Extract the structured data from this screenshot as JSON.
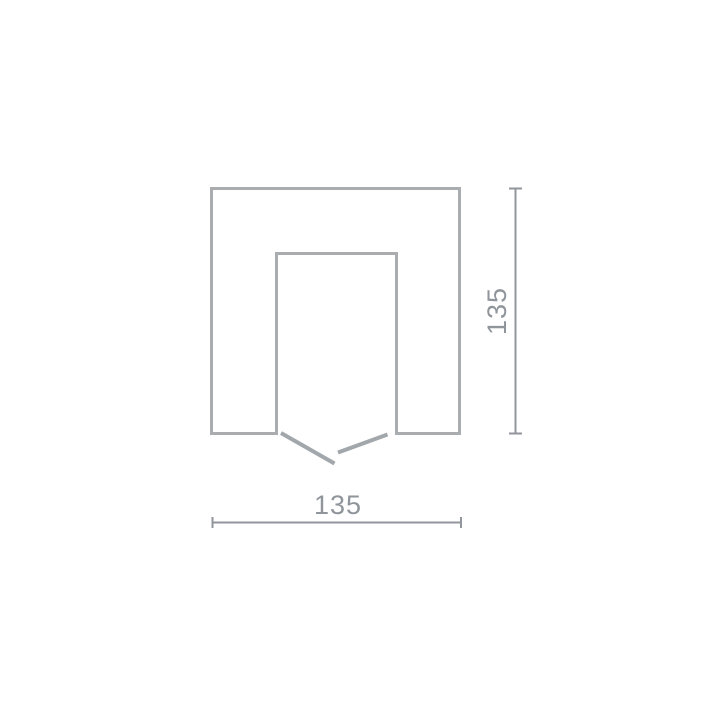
{
  "diagram": {
    "type": "technical-dimension-drawing",
    "description": "Square cross-section profile with rectangular notch open at the bottom and break marks at the opening",
    "dimensions": {
      "height": {
        "value": "135",
        "orientation": "vertical",
        "side": "right"
      },
      "width": {
        "value": "135",
        "orientation": "horizontal",
        "side": "bottom"
      }
    },
    "colors": {
      "outline": "#a9adb0",
      "break_mark": "#a2a7ab",
      "dimension_line": "#90969b",
      "label_text": "#8f959a",
      "background": "#ffffff"
    }
  }
}
